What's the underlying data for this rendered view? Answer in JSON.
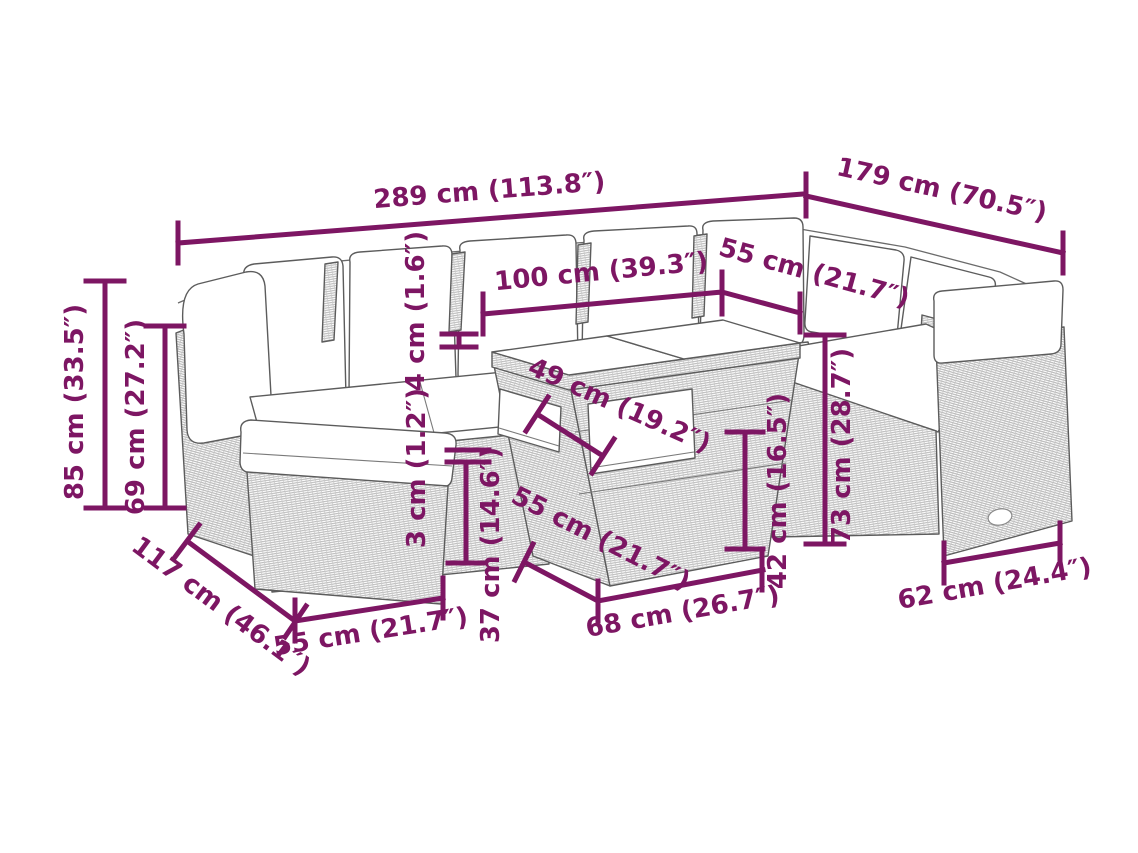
{
  "diagram": {
    "kind": "garden furniture set dimension diagram",
    "colors": {
      "dimension_accent": "#7d1663",
      "line_art": "#5c5c5c",
      "hatch": "#b5b5b5",
      "background": "#ffffff"
    },
    "annotations": {
      "overall_width": "289 cm (113.8″)",
      "overall_depth": "179 cm (70.5″)",
      "table_top_length": "100 cm (39.3″)",
      "table_top_depth": "55 cm (21.7″)",
      "glass_thickness": "4 cm (1.6″)",
      "overall_height": "85 cm (33.5″)",
      "back_height": "69 cm (27.2″)",
      "shelf_width": "49 cm (19.2″)",
      "cushion_thickness": "3 cm (1.2″)",
      "seat_height": "37 cm (14.6″)",
      "table_base_depth": "55 cm (21.7″)",
      "table_base_height": "42 cm (16.5″)",
      "right_section_height": "73 cm (28.7″)",
      "section_depth": "117 cm (46.1″)",
      "footstool_width": "55 cm (21.7″)",
      "table_base_length": "68 cm (26.7″)",
      "right_seat_depth": "62 cm (24.4″)"
    }
  }
}
